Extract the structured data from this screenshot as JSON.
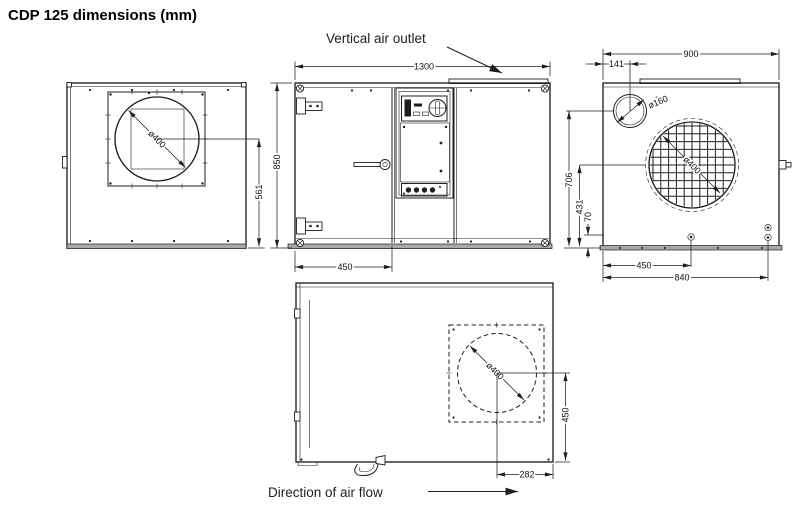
{
  "title": "CDP 125 dimensions (mm)",
  "colors": {
    "line": "#1f1f1f",
    "background": "#ffffff",
    "baseplate_gray": "#a9a9a9"
  },
  "annotations": {
    "vertical_air_outlet": "Vertical air outlet",
    "direction_of_air_flow": "Direction of air flow"
  },
  "views": {
    "side_left": {
      "fan_diameter": "ø400",
      "fan_center_to_base": "561"
    },
    "front": {
      "width": "1300",
      "height": "850",
      "door_width": "450"
    },
    "side_right": {
      "depth": "900",
      "duct_offset_from_edge": "141",
      "duct_diameter": "ø160",
      "grille_diameter": "ø400",
      "duct_center_height": "706",
      "grille_center_height": "431",
      "drain_height": "70",
      "drain_offset": "450",
      "connections_offset": "840"
    },
    "top": {
      "outlet_diameter": "ø400",
      "outlet_center_to_side": "450",
      "outlet_center_to_end": "282"
    }
  }
}
